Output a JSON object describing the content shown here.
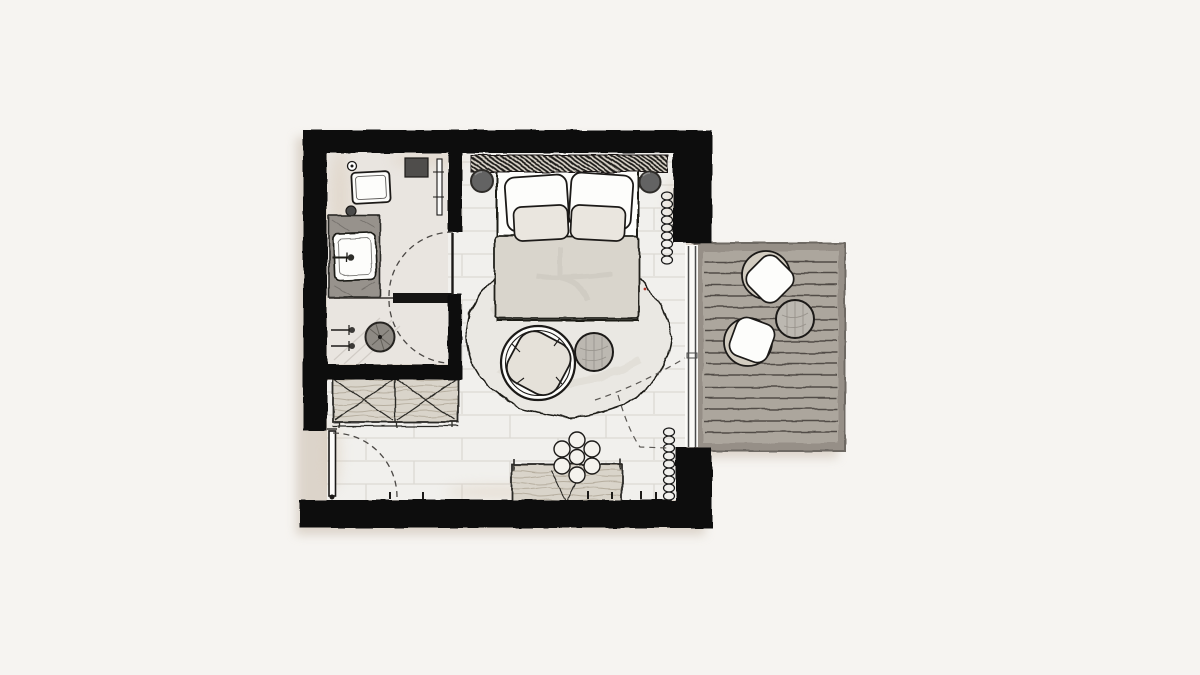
{
  "canvas": {
    "width_px": 1200,
    "height_px": 675,
    "style": "hand-drawn architectural sketch, top view"
  },
  "palette": {
    "paper": "#f6f4f1",
    "ink": "#1c1a18",
    "wall": "#0d0c0b",
    "floor": "#f1f0ed",
    "floorLine": "#dcd9d4",
    "bathFloor": "#e9e5e0",
    "deck": "#aca69d",
    "deckEdge": "#968f87",
    "deckLine": "#514c46",
    "rug": "#eae8e3",
    "duvet": "#d9d5cc",
    "linen": "#fdfdfb",
    "pillowFront": "#eae6df",
    "wood": "#d9d4ca",
    "woodLine": "#b6ae9f",
    "nightstand": "#636363",
    "counter": "#97928c",
    "fixture": "#8e8a84",
    "shell": "#d2ccc0",
    "cushion": "#e5e1d9",
    "tableTop": "#bcb8b1",
    "glassFrame": "#4a4a4a",
    "shadow": "#c8bbab",
    "blush": "#d8c8b4",
    "accentDot": "#b23a2e"
  },
  "plan": {
    "rooms": [
      {
        "id": "bathroom",
        "items": [
          "toilet",
          "flush-button",
          "wall-cabinet",
          "mirror",
          "vanity-sink",
          "faucet",
          "towel-rail",
          "shower-head",
          "shower-valves"
        ]
      },
      {
        "id": "bedroom",
        "items": [
          "double-bed",
          "headboard",
          "pillow-back-left",
          "pillow-back-right",
          "pillow-front-left",
          "pillow-front-right",
          "duvet",
          "nightstand-left",
          "nightstand-right",
          "area-rug",
          "lounge-chair",
          "side-table",
          "console-desk",
          "flower-stool",
          "wardrobe",
          "curtain-upper",
          "curtain-lower"
        ]
      },
      {
        "id": "entry",
        "items": [
          "entry-door",
          "wardrobe"
        ]
      },
      {
        "id": "balcony",
        "items": [
          "deck-boards",
          "balcony-chair-1",
          "balcony-chair-2",
          "balcony-table"
        ]
      }
    ],
    "doors": [
      {
        "id": "entry-door",
        "type": "swing",
        "swing_arc": true
      },
      {
        "id": "bathroom-door",
        "type": "swing",
        "swing_arc": true
      },
      {
        "id": "shower-door",
        "type": "swing",
        "swing_arc": true
      },
      {
        "id": "balcony-door",
        "type": "sliding-glass"
      }
    ],
    "counts": {
      "pillows": 4,
      "balcony_chairs": 2,
      "curtain_symbols": 2,
      "deck_boards": 16,
      "wardrobe_sections": 2
    }
  }
}
